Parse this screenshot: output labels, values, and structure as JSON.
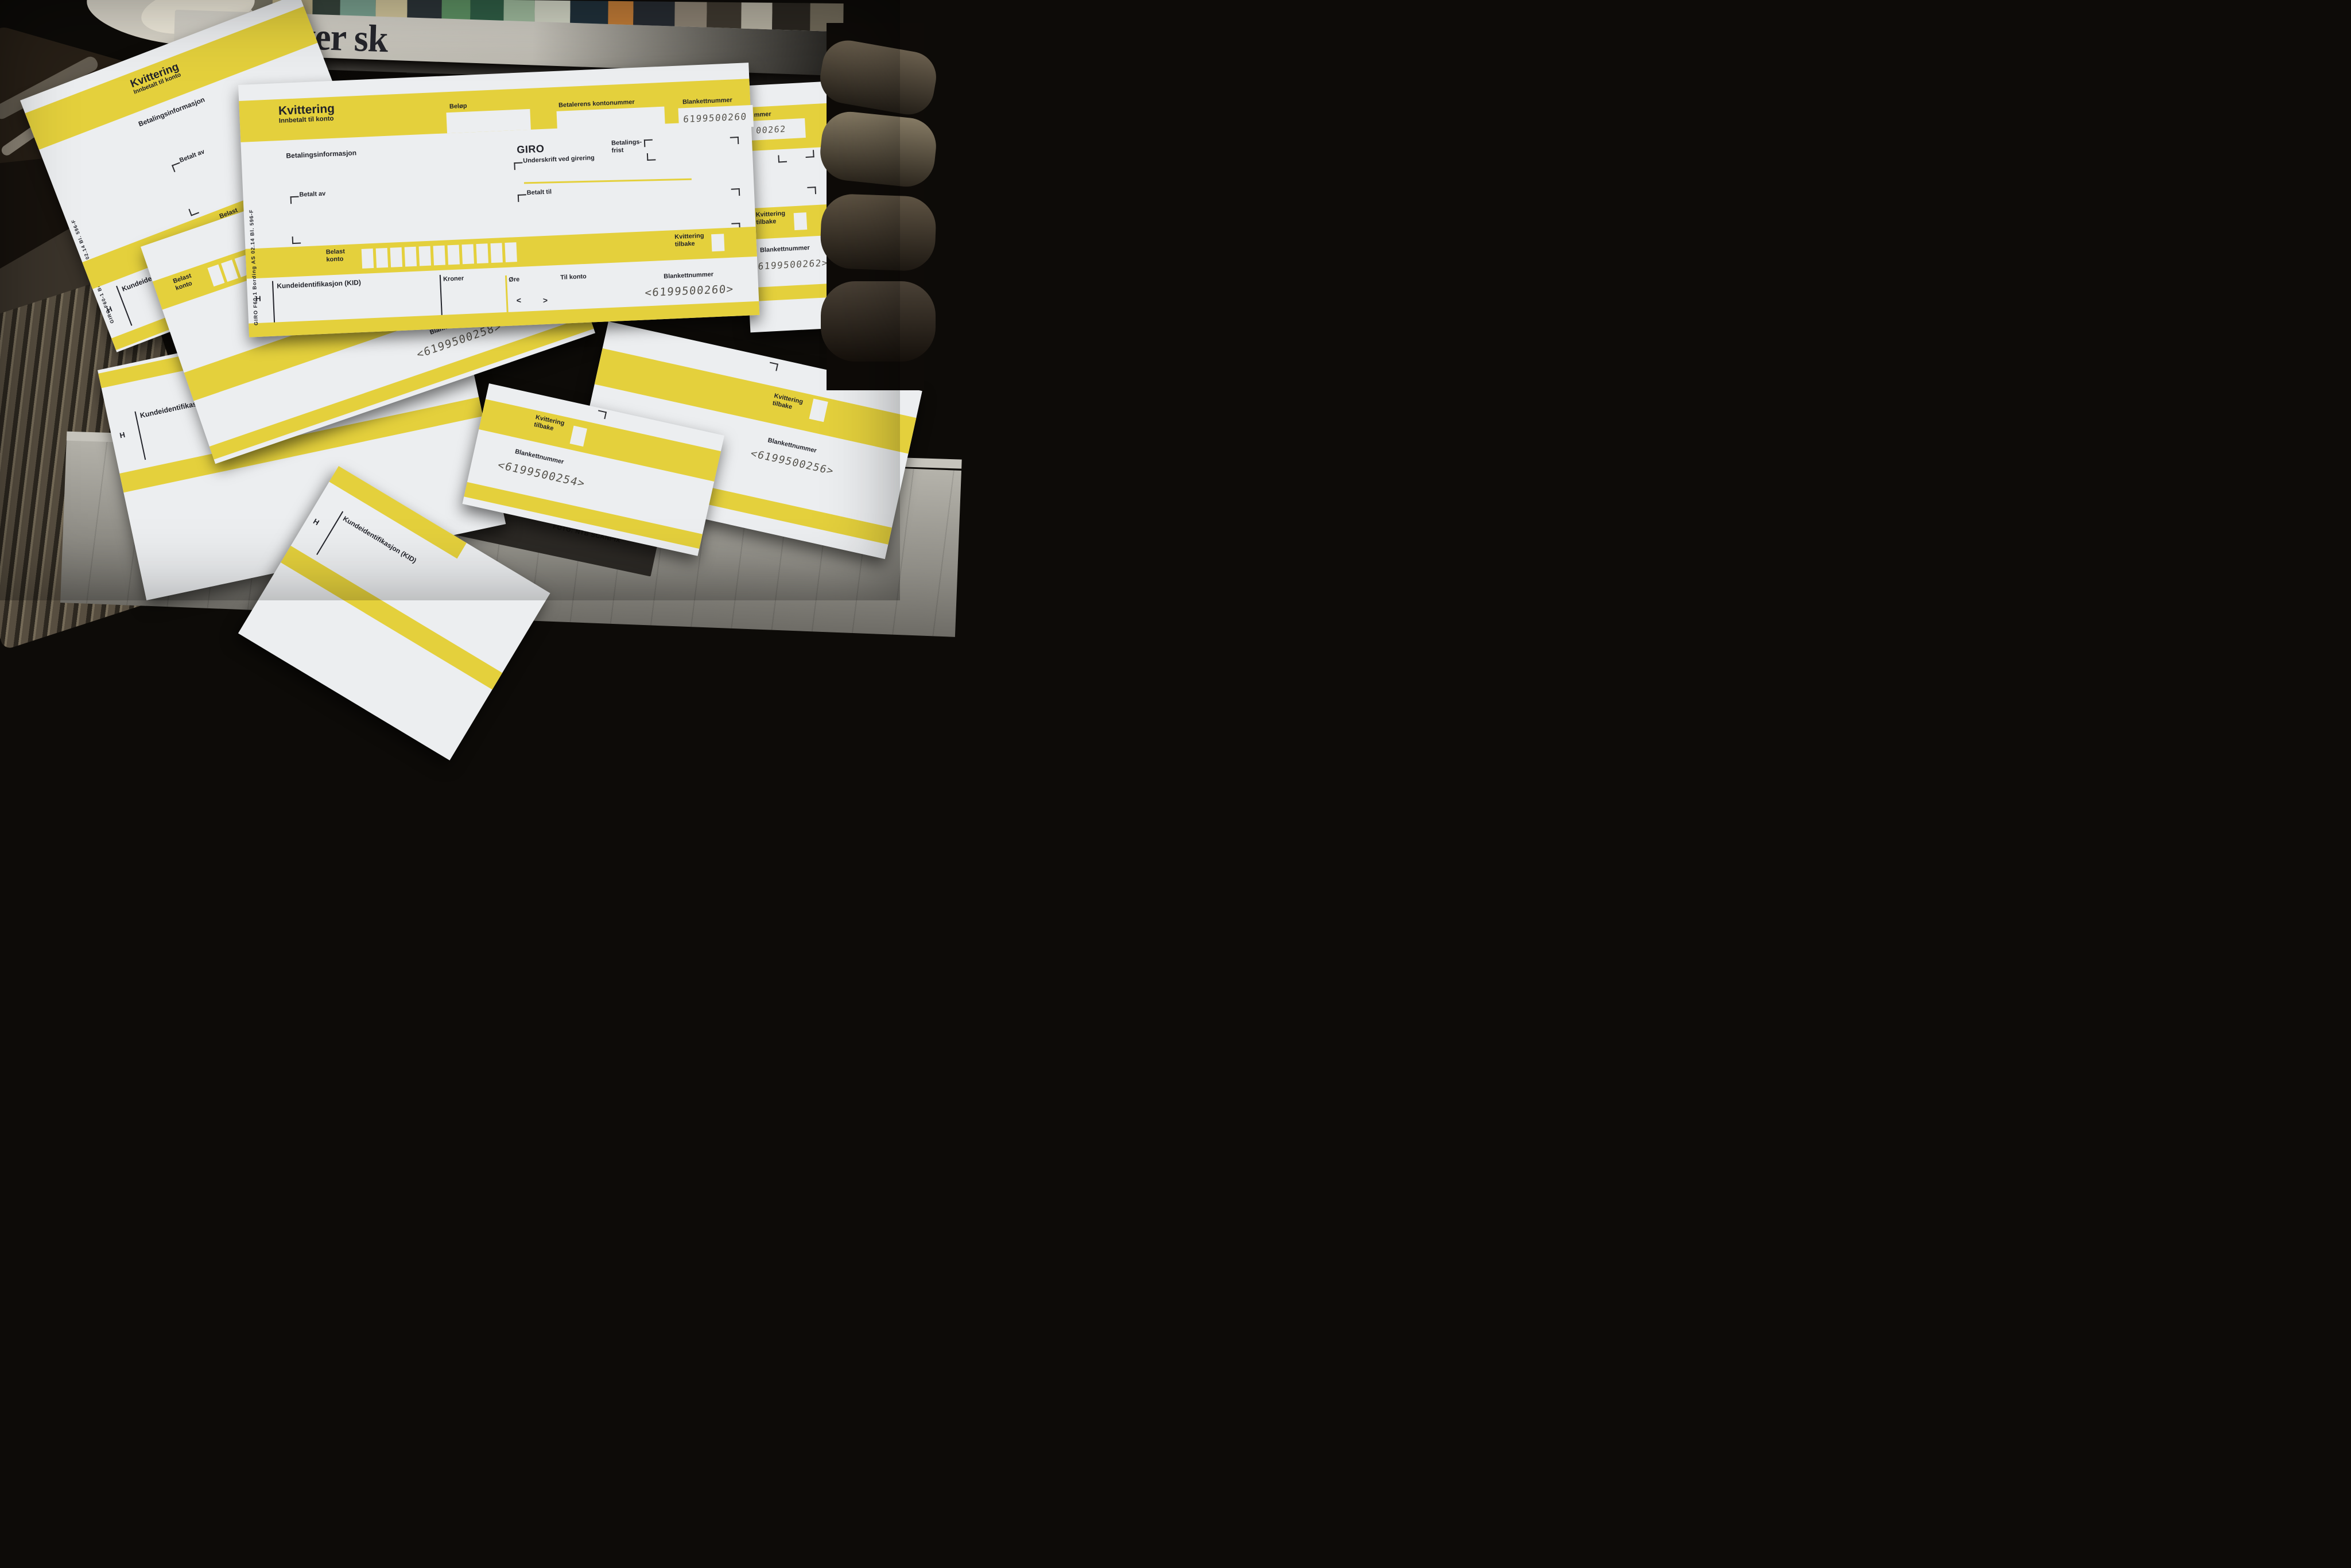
{
  "colors": {
    "giro_yellow": "#e4d03c",
    "paper": "#eceef0",
    "ink": "#22232a",
    "ocr_ink": "#55524b",
    "background": "#0d0b08",
    "newsprint": "#a8a69e",
    "headline_ink": "#26262c",
    "photo_block": "#2c2925"
  },
  "newspaper": {
    "headline": "Elever sk",
    "photo_credit": "FOTO: NTB SCANPIX"
  },
  "giro": {
    "print_code": "GIRO F60-1  Bording AS  02.14  Bl. 596-F",
    "title": "Kvittering",
    "subtitle": "Innbetalt til konto",
    "payment_info": "Betalingsinformasjon",
    "amount": "Beløp",
    "payer_account": "Betalerens kontonummer",
    "form_number": "Blankettnummer",
    "giro_word": "GIRO",
    "due_line1": "Betalings-",
    "due_line2": "frist",
    "signature": "Underskrift ved girering",
    "paid_by": "Betalt av",
    "paid_to": "Betalt til",
    "debit_line1": "Belast",
    "debit_line2": "konto",
    "receipt_line1": "Kvittering",
    "receipt_line2": "tilbake",
    "kid": "Kundeidentifikasjon (KID)",
    "kroner": "Kroner",
    "ore": "Øre",
    "to_account": "Til konto",
    "h": "H",
    "lt": "<",
    "gt": ">"
  },
  "numbers": {
    "main_top": "6199500260",
    "main_bottom": "<6199500260>",
    "right_label_partial": "mmer",
    "right_top_partial": "00262",
    "right_bottom": "<6199500262>",
    "mid_bottom": "<6199500258>",
    "center_bottom": "<6199500254>",
    "bottomright_bottom": "<6199500256>"
  },
  "collage_colors": [
    {
      "c": "#4a3c2e",
      "w": 58,
      "h": 70
    },
    {
      "c": "#23201b",
      "w": 64,
      "h": 120
    },
    {
      "c": "#7e7a6a",
      "w": 52,
      "h": 90
    },
    {
      "c": "#c2b68e",
      "w": 70,
      "h": 60
    },
    {
      "c": "#37443c",
      "w": 48,
      "h": 110
    },
    {
      "c": "#79a08f",
      "w": 62,
      "h": 75
    },
    {
      "c": "#d0c49a",
      "w": 55,
      "h": 95
    },
    {
      "c": "#2c3438",
      "w": 60,
      "h": 130
    },
    {
      "c": "#5d9163",
      "w": 50,
      "h": 85
    },
    {
      "c": "#2f5d45",
      "w": 58,
      "h": 118
    },
    {
      "c": "#9db89b",
      "w": 54,
      "h": 70
    },
    {
      "c": "#cfd2c2",
      "w": 62,
      "h": 100
    },
    {
      "c": "#20303a",
      "w": 66,
      "h": 128
    },
    {
      "c": "#bf7a36",
      "w": 44,
      "h": 88
    },
    {
      "c": "#262b31",
      "w": 72,
      "h": 132
    },
    {
      "c": "#8b8172",
      "w": 56,
      "h": 84
    },
    {
      "c": "#3e382f",
      "w": 60,
      "h": 122
    },
    {
      "c": "#b3ae9f",
      "w": 54,
      "h": 78
    },
    {
      "c": "#2a2620",
      "w": 66,
      "h": 130
    },
    {
      "c": "#6e6757",
      "w": 58,
      "h": 96
    }
  ]
}
